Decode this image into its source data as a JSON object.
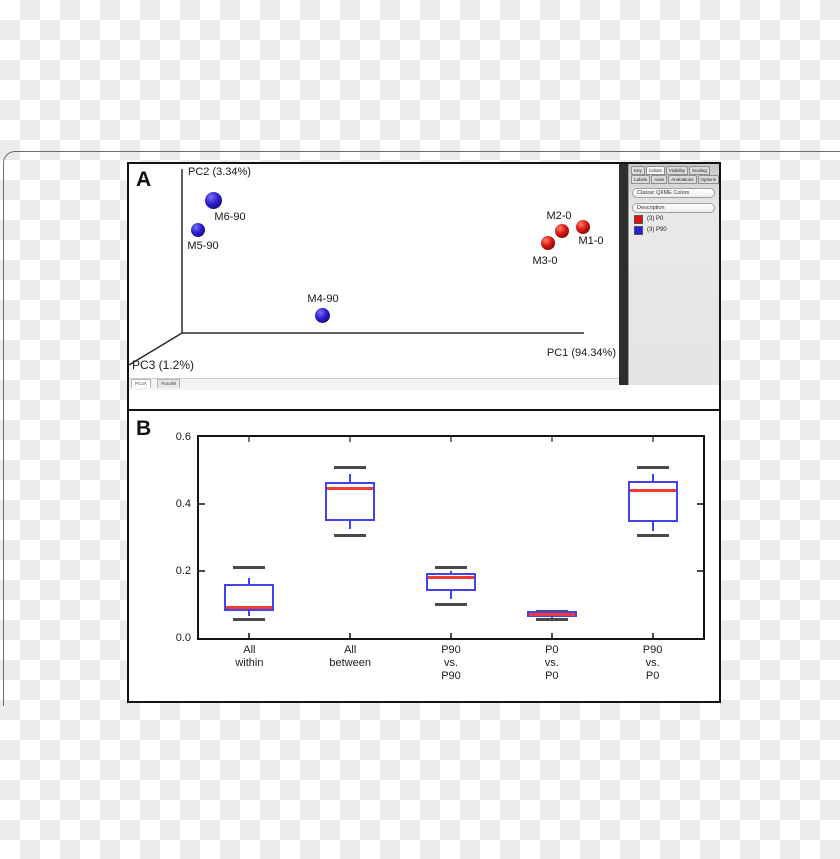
{
  "figure": {
    "panel_a": {
      "letter": "A",
      "axis_labels": {
        "pc1": "PC1 (94.34%)",
        "pc2": "PC2 (3.34%)",
        "pc3": "PC3 (1.2%)"
      },
      "bottom_tabs": [
        {
          "label": "PCoA"
        },
        {
          "label": "Parallel"
        }
      ],
      "sidebar": {
        "tabs_row1": [
          "Key",
          "Colors",
          "Visibility",
          "Scaling"
        ],
        "tabs_row2": [
          "Labels",
          "Axes",
          "Animations",
          "Options"
        ],
        "active_tab": "Colors",
        "colors_button": "Classic QIIME Colors",
        "category_button": "Description",
        "legend": [
          {
            "label": "(3) P0",
            "color": "#e01010"
          },
          {
            "label": "(3) P90",
            "color": "#2222dd"
          }
        ]
      }
    },
    "panel_b": {
      "letter": "B"
    }
  },
  "chart_data": [
    {
      "id": "panel_a_pcoa",
      "type": "scatter",
      "title": "PCoA ordination (Emperor viewer)",
      "axes": {
        "x": "PC1 (94.34%)",
        "y": "PC2 (3.34%)",
        "z": "PC3 (1.2%)"
      },
      "legend_position": "right sidebar",
      "groups": [
        {
          "name": "P0",
          "count": 3,
          "color": "#d61313",
          "highlight": "#ff8066",
          "shadow": "#4f0202"
        },
        {
          "name": "P90",
          "count": 3,
          "color": "#2a1ccd",
          "highlight": "#7d6ef7",
          "shadow": "#0e0640"
        }
      ],
      "points": [
        {
          "label": "M6-90",
          "group": "P90",
          "cx": 84,
          "cy": 36,
          "d": 17,
          "lx": 101,
          "ly": 53
        },
        {
          "label": "M5-90",
          "group": "P90",
          "cx": 69,
          "cy": 66,
          "d": 14,
          "lx": 74,
          "ly": 82
        },
        {
          "label": "M4-90",
          "group": "P90",
          "cx": 193,
          "cy": 151,
          "d": 15,
          "lx": 194,
          "ly": 135
        },
        {
          "label": "M2-0",
          "group": "P0",
          "cx": 433,
          "cy": 67,
          "d": 14,
          "lx": 430,
          "ly": 52
        },
        {
          "label": "M1-0",
          "group": "P0",
          "cx": 454,
          "cy": 63,
          "d": 14,
          "lx": 462,
          "ly": 77
        },
        {
          "label": "M3-0",
          "group": "P0",
          "cx": 419,
          "cy": 79,
          "d": 14,
          "lx": 416,
          "ly": 97
        }
      ]
    },
    {
      "id": "panel_b_boxplot",
      "type": "box",
      "title": "",
      "xlabel": "",
      "ylabel": "",
      "ylim": [
        0,
        0.6
      ],
      "yticks": [
        0.0,
        0.2,
        0.4,
        0.6
      ],
      "grid": false,
      "categories": [
        [
          "All",
          "within"
        ],
        [
          "All",
          "between"
        ],
        [
          "P90",
          "vs.",
          "P90"
        ],
        [
          "P0",
          "vs.",
          "P0"
        ],
        [
          "P90",
          "vs.",
          "P0"
        ]
      ],
      "boxes": [
        {
          "cap_low": 0.055,
          "whisker_low": 0.065,
          "q1": 0.08,
          "median": 0.09,
          "q3": 0.16,
          "whisker_high": 0.18,
          "cap_high": 0.21
        },
        {
          "cap_low": 0.305,
          "whisker_low": 0.325,
          "q1": 0.35,
          "median": 0.445,
          "q3": 0.465,
          "whisker_high": 0.49,
          "cap_high": 0.51
        },
        {
          "cap_low": 0.1,
          "whisker_low": 0.115,
          "q1": 0.14,
          "median": 0.18,
          "q3": 0.195,
          "whisker_high": 0.2,
          "cap_high": 0.21
        },
        {
          "cap_low": 0.055,
          "whisker_low": 0.06,
          "q1": 0.063,
          "median": 0.07,
          "q3": 0.08,
          "whisker_high": 0.08,
          "cap_high": 0.08
        },
        {
          "cap_low": 0.305,
          "whisker_low": 0.32,
          "q1": 0.345,
          "median": 0.44,
          "q3": 0.47,
          "whisker_high": 0.49,
          "cap_high": 0.51
        }
      ],
      "box_color": "#4444ee",
      "median_color": "#f03b2d",
      "cap_color": "#4a4a4a"
    }
  ]
}
